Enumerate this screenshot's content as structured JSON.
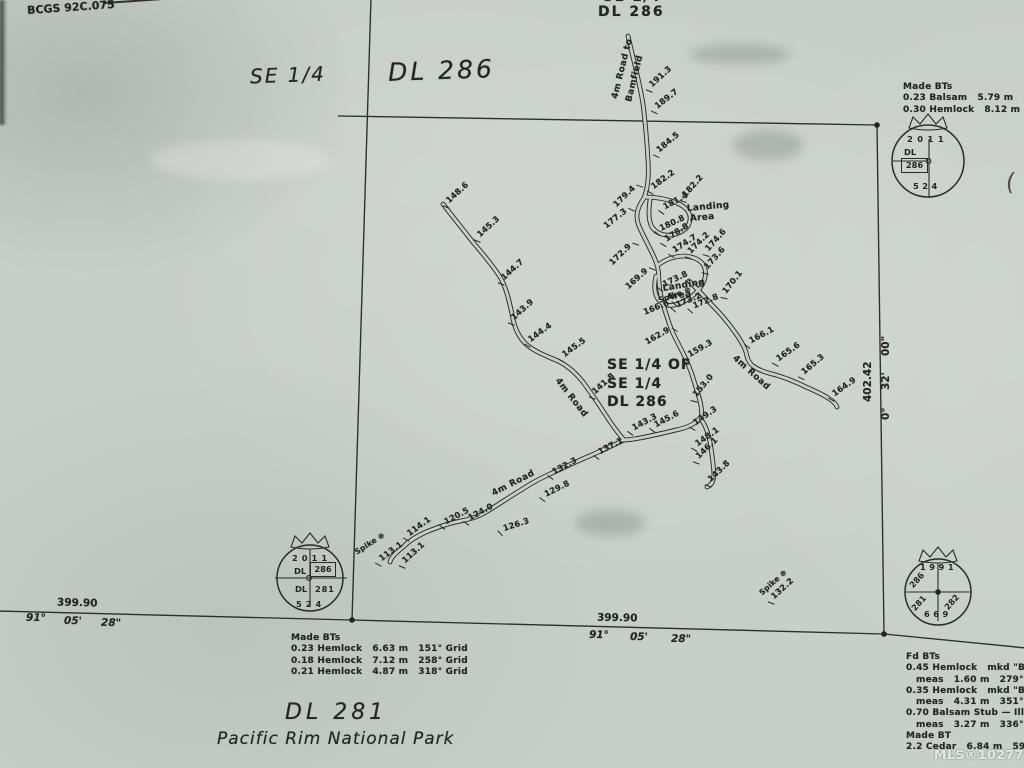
{
  "page": {
    "map_ref": "BCGS 92C.075",
    "watermark": "MLS®1027791",
    "stray_paren": "("
  },
  "colors": {
    "paper": "#c8cec9",
    "ink": "#262826"
  },
  "titles": {
    "se_quarter_left": "SE 1/4",
    "dl_286_left": "DL 286",
    "se_quarter_top_clipped": "SE 1/4",
    "dl_286_top": "DL 286",
    "center": [
      "SE 1/4 OF",
      "SE 1/4",
      "DL 286"
    ],
    "dl_281": "DL 281",
    "park": "Pacific Rim National Park"
  },
  "bearings": {
    "south_left": {
      "distance": "399.90",
      "deg": "91°",
      "min": "05'",
      "sec": "28\""
    },
    "south_mid": {
      "distance": "399.90",
      "deg": "91°",
      "min": "05'",
      "sec": "28\""
    },
    "east": {
      "distance": "402.42",
      "deg": "0°",
      "min": "32'",
      "sec": "00\""
    }
  },
  "monuments": [
    {
      "year": "2011",
      "label_dl": "DL",
      "lot": "286",
      "plan": "524"
    },
    {
      "year": "2011",
      "label_dl_top": "DL",
      "lot_top": "286",
      "label_dl_bottom": "DL",
      "lot_bottom": "281",
      "plan": "524"
    },
    {
      "year": "1991",
      "lot_ul": "286",
      "lot_ll": "281",
      "lot_lr": "282",
      "plan": "669"
    }
  ],
  "bt_blocks": [
    {
      "x": 903,
      "y": 82,
      "lines": [
        "Made BTs",
        "0.23 Balsam   5.79 m   325° G",
        "0.30 Hemlock   8.12 m   79° Gr"
      ]
    },
    {
      "x": 291,
      "y": 633,
      "lines": [
        "Made BTs",
        "0.23 Hemlock   6.63 m   151° Grid",
        "0.18 Hemlock   7.12 m   258° Grid",
        "0.21 Hemlock   4.87 m   318° Grid"
      ]
    },
    {
      "x": 906,
      "y": 652,
      "lines": [
        "Fd BTs",
        "0.45 Hemlock   mkd \"BT",
        "   meas   1.60 m   279° G",
        "0.35 Hemlock   mkd \"BT",
        "   meas   4.31 m   351° G",
        "0.70 Balsam Stub — Illeg",
        "   meas   3.27 m   336° ",
        "Made BT",
        "2.2 Cedar   6.84 m   59°"
      ]
    }
  ],
  "map_texts": [
    {
      "t": "191.3",
      "x": 644,
      "y": 86,
      "r": -42,
      "k": "s"
    },
    {
      "t": "189.7",
      "x": 649,
      "y": 107,
      "r": -38,
      "k": "s"
    },
    {
      "t": "184.5",
      "x": 651,
      "y": 151,
      "r": -40,
      "k": "s"
    },
    {
      "t": "182.2",
      "x": 645,
      "y": 187,
      "r": -36,
      "k": "s"
    },
    {
      "t": "179.4",
      "x": 615,
      "y": 200,
      "r": -44,
      "k": "s",
      "e": 1
    },
    {
      "t": "181.4",
      "x": 656,
      "y": 206,
      "r": -28,
      "k": "s"
    },
    {
      "t": "182.2",
      "x": 678,
      "y": 197,
      "r": -48,
      "k": "s"
    },
    {
      "t": "180.8",
      "x": 652,
      "y": 227,
      "r": -25,
      "k": "s"
    },
    {
      "t": "178.8",
      "x": 658,
      "y": 239,
      "r": -33,
      "k": "s"
    },
    {
      "t": "177.3",
      "x": 605,
      "y": 221,
      "r": -38,
      "k": "s",
      "e": 1
    },
    {
      "t": "174.7",
      "x": 666,
      "y": 250,
      "r": -33,
      "k": "s"
    },
    {
      "t": "174.2",
      "x": 683,
      "y": 253,
      "r": -45,
      "k": "s"
    },
    {
      "t": "174.6",
      "x": 701,
      "y": 251,
      "r": -48,
      "k": "s"
    },
    {
      "t": "173.6",
      "x": 700,
      "y": 269,
      "r": -48,
      "k": "s"
    },
    {
      "t": "172.9",
      "x": 611,
      "y": 258,
      "r": -44,
      "k": "s",
      "e": 1
    },
    {
      "t": "169.9",
      "x": 627,
      "y": 282,
      "r": -42,
      "k": "s",
      "e": 1
    },
    {
      "t": "173.8",
      "x": 655,
      "y": 283,
      "r": -25,
      "k": "s"
    },
    {
      "t": "173.2",
      "x": 668,
      "y": 303,
      "r": -22,
      "k": "s"
    },
    {
      "t": "172.8",
      "x": 685,
      "y": 304,
      "r": -22,
      "k": "s"
    },
    {
      "t": "170.1",
      "x": 719,
      "y": 294,
      "r": -52,
      "k": "s"
    },
    {
      "t": "166.6",
      "x": 644,
      "y": 307,
      "r": -22,
      "k": "s",
      "e": 1
    },
    {
      "t": "162.9",
      "x": 646,
      "y": 337,
      "r": -30,
      "k": "s",
      "e": 1
    },
    {
      "t": "159.3",
      "x": 681,
      "y": 354,
      "r": -30,
      "k": "s"
    },
    {
      "t": "153.0",
      "x": 689,
      "y": 397,
      "r": -50,
      "k": "s"
    },
    {
      "t": "166.1",
      "x": 742,
      "y": 340,
      "r": -28,
      "k": "s"
    },
    {
      "t": "165.6",
      "x": 770,
      "y": 359,
      "r": -35,
      "k": "s"
    },
    {
      "t": "165.3",
      "x": 796,
      "y": 373,
      "r": -40,
      "k": "s"
    },
    {
      "t": "164.9",
      "x": 826,
      "y": 394,
      "r": -35,
      "k": "s"
    },
    {
      "t": "143.3",
      "x": 625,
      "y": 427,
      "r": -28,
      "k": "s"
    },
    {
      "t": "145.6",
      "x": 647,
      "y": 424,
      "r": -28,
      "k": "s"
    },
    {
      "t": "149.3",
      "x": 687,
      "y": 423,
      "r": -35,
      "k": "s"
    },
    {
      "t": "148.1",
      "x": 689,
      "y": 444,
      "r": -35,
      "k": "s"
    },
    {
      "t": "146.1",
      "x": 691,
      "y": 458,
      "r": -44,
      "k": "s"
    },
    {
      "t": "143.8",
      "x": 703,
      "y": 481,
      "r": -44,
      "k": "s"
    },
    {
      "t": "148.6",
      "x": 441,
      "y": 202,
      "r": -42,
      "k": "s"
    },
    {
      "t": "145.3",
      "x": 472,
      "y": 236,
      "r": -42,
      "k": "s"
    },
    {
      "t": "144.7",
      "x": 496,
      "y": 279,
      "r": -42,
      "k": "s"
    },
    {
      "t": "143.9",
      "x": 506,
      "y": 319,
      "r": -42,
      "k": "s"
    },
    {
      "t": "144.4",
      "x": 522,
      "y": 340,
      "r": -36,
      "k": "s"
    },
    {
      "t": "145.5",
      "x": 556,
      "y": 355,
      "r": -36,
      "k": "s"
    },
    {
      "t": "141.8",
      "x": 587,
      "y": 393,
      "r": -42,
      "k": "s"
    },
    {
      "t": "137.1",
      "x": 591,
      "y": 451,
      "r": -28,
      "k": "s"
    },
    {
      "t": "132.3",
      "x": 545,
      "y": 471,
      "r": -28,
      "k": "s"
    },
    {
      "t": "129.8",
      "x": 537,
      "y": 493,
      "r": -26,
      "k": "s"
    },
    {
      "t": "124.0",
      "x": 461,
      "y": 517,
      "r": -28,
      "k": "s"
    },
    {
      "t": "120.5",
      "x": 437,
      "y": 521,
      "r": -28,
      "k": "s"
    },
    {
      "t": "126.3",
      "x": 495,
      "y": 526,
      "r": -18,
      "k": "s"
    },
    {
      "t": "114.1",
      "x": 401,
      "y": 534,
      "r": -36,
      "k": "s"
    },
    {
      "t": "113.1",
      "x": 373,
      "y": 559,
      "r": -36,
      "k": "s"
    },
    {
      "t": "113.1",
      "x": 397,
      "y": 562,
      "r": -42,
      "k": "s"
    },
    {
      "t": "132.2",
      "x": 766,
      "y": 598,
      "r": -42,
      "k": "s"
    },
    {
      "t": "4m Road to",
      "x": 616,
      "y": 93,
      "r": -76,
      "k": "n"
    },
    {
      "t": "Bamfield",
      "x": 630,
      "y": 96,
      "r": -76,
      "k": "n"
    },
    {
      "t": "4m Road",
      "x": 556,
      "y": 374,
      "r": 52,
      "k": "n"
    },
    {
      "t": "4m Road",
      "x": 493,
      "y": 489,
      "r": -27,
      "k": "n"
    },
    {
      "t": "4m Road",
      "x": 733,
      "y": 352,
      "r": 42,
      "k": "n"
    },
    {
      "t": "Landing",
      "x": 687,
      "y": 204,
      "r": -5,
      "k": "a"
    },
    {
      "t": "Area",
      "x": 690,
      "y": 214,
      "r": -5,
      "k": "a"
    },
    {
      "t": "Landing",
      "x": 663,
      "y": 284,
      "r": -9,
      "k": "a"
    },
    {
      "t": "Area",
      "x": 667,
      "y": 293,
      "r": -9,
      "k": "a"
    },
    {
      "t": "Spike ⊕",
      "x": 659,
      "y": 296,
      "r": -20,
      "k": "p"
    },
    {
      "t": "Spike ⊕",
      "x": 356,
      "y": 548,
      "r": -33,
      "k": "p"
    },
    {
      "t": "Spike ⊕",
      "x": 761,
      "y": 589,
      "r": -42,
      "k": "p"
    }
  ]
}
